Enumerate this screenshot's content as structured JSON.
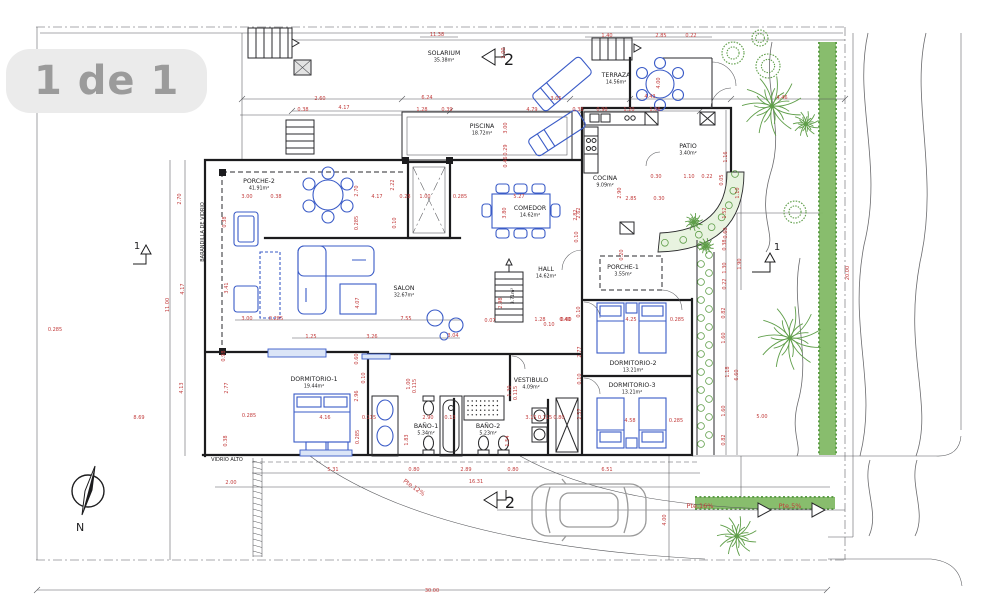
{
  "viewer": {
    "page_indicator": "1 de 1"
  },
  "colors": {
    "dimension_text": "#c23b3b",
    "ink": "#1c1c1e",
    "furniture_blue": "#3a5bc7",
    "vegetation_green": "#5f9e49",
    "hedge_fill": "#82b965",
    "paper": "#ffffff",
    "pill_bg": "#ebebeb",
    "pill_text": "#9b9b9b"
  },
  "plan": {
    "rooms": [
      {
        "name": "SOLARIUM",
        "area": "35.38m²",
        "x": 444,
        "y": 55
      },
      {
        "name": "TERRAZA",
        "area": "14.56m²",
        "x": 616,
        "y": 77
      },
      {
        "name": "PISCINA",
        "area": "18.72m²",
        "x": 482,
        "y": 128
      },
      {
        "name": "PATIO",
        "area": "3.40m²",
        "x": 688,
        "y": 148
      },
      {
        "name": "COCINA",
        "area": "9.09m²",
        "x": 605,
        "y": 180
      },
      {
        "name": "COMEDOR",
        "area": "14.62m²",
        "x": 530,
        "y": 210
      },
      {
        "name": "HALL",
        "area": "14.62m²",
        "x": 546,
        "y": 271
      },
      {
        "name": "PORCHE-1",
        "area": "3.55m²",
        "x": 623,
        "y": 269
      },
      {
        "name": "PORCHE-2",
        "area": "41.91m²",
        "x": 259,
        "y": 183
      },
      {
        "name": "SALON",
        "area": "32.67m²",
        "x": 404,
        "y": 290
      },
      {
        "name": "DORMITORIO-1",
        "area": "19.44m²",
        "x": 314,
        "y": 381
      },
      {
        "name": "DORMITORIO-2",
        "area": "13.21m²",
        "x": 633,
        "y": 365
      },
      {
        "name": "DORMITORIO-3",
        "area": "13.21m²",
        "x": 632,
        "y": 387
      },
      {
        "name": "VESTIBULO",
        "area": "4.09m²",
        "x": 531,
        "y": 382
      },
      {
        "name": "BAÑO-1",
        "area": "5.34m²",
        "x": 426,
        "y": 428
      },
      {
        "name": "BAÑO-2",
        "area": "5.23m²",
        "x": 488,
        "y": 428
      }
    ],
    "dimensions": [
      {
        "t": "11.38",
        "x": 437,
        "y": 36
      },
      {
        "t": "1.40",
        "x": 607,
        "y": 37
      },
      {
        "t": "2.85",
        "x": 661,
        "y": 37
      },
      {
        "t": "0.22",
        "x": 691,
        "y": 37
      },
      {
        "t": "2.00",
        "x": 505,
        "y": 53,
        "v": 1
      },
      {
        "t": "2.60",
        "x": 320,
        "y": 100
      },
      {
        "t": "6.24",
        "x": 427,
        "y": 99
      },
      {
        "t": "3.05",
        "x": 556,
        "y": 100
      },
      {
        "t": "4.43",
        "x": 650,
        "y": 98
      },
      {
        "t": "4.46",
        "x": 782,
        "y": 99
      },
      {
        "t": "4.00",
        "x": 660,
        "y": 83,
        "v": 1
      },
      {
        "t": "0.38",
        "x": 303,
        "y": 111
      },
      {
        "t": "4.17",
        "x": 344,
        "y": 109
      },
      {
        "t": "1.28",
        "x": 422,
        "y": 111
      },
      {
        "t": "0.39",
        "x": 447,
        "y": 111
      },
      {
        "t": "4.79",
        "x": 532,
        "y": 111
      },
      {
        "t": "0.38",
        "x": 578,
        "y": 111
      },
      {
        "t": "0.90",
        "x": 602,
        "y": 111
      },
      {
        "t": "1.20",
        "x": 629,
        "y": 111
      },
      {
        "t": "1.06",
        "x": 655,
        "y": 111
      },
      {
        "t": "3.00",
        "x": 507,
        "y": 128,
        "v": 1
      },
      {
        "t": "0.29",
        "x": 507,
        "y": 150,
        "v": 1
      },
      {
        "t": "0.46",
        "x": 507,
        "y": 162,
        "v": 1
      },
      {
        "t": "2.70",
        "x": 181,
        "y": 199,
        "v": 1
      },
      {
        "t": "4.17",
        "x": 184,
        "y": 289,
        "v": 1
      },
      {
        "t": "11.00",
        "x": 169,
        "y": 305,
        "v": 1
      },
      {
        "t": "4.13",
        "x": 183,
        "y": 388,
        "v": 1
      },
      {
        "t": "8.69",
        "x": 139,
        "y": 419
      },
      {
        "t": "0.285",
        "x": 55,
        "y": 331
      },
      {
        "t": "0.38",
        "x": 226,
        "y": 222,
        "v": 1
      },
      {
        "t": "3.41",
        "x": 228,
        "y": 288,
        "v": 1
      },
      {
        "t": "0.98",
        "x": 225,
        "y": 356,
        "v": 1
      },
      {
        "t": "2.77",
        "x": 228,
        "y": 388,
        "v": 1
      },
      {
        "t": "0.38",
        "x": 227,
        "y": 441,
        "v": 1
      },
      {
        "t": "3.00",
        "x": 247,
        "y": 198
      },
      {
        "t": "0.38",
        "x": 276,
        "y": 198
      },
      {
        "t": "2.70",
        "x": 358,
        "y": 191,
        "v": 1
      },
      {
        "t": "2.22",
        "x": 394,
        "y": 185,
        "v": 1
      },
      {
        "t": "4.17",
        "x": 377,
        "y": 198
      },
      {
        "t": "0.28",
        "x": 405,
        "y": 198
      },
      {
        "t": "1.00",
        "x": 425,
        "y": 198
      },
      {
        "t": "0.285",
        "x": 358,
        "y": 223,
        "v": 1
      },
      {
        "t": "0.10",
        "x": 396,
        "y": 223,
        "v": 1
      },
      {
        "t": "3.00",
        "x": 247,
        "y": 320
      },
      {
        "t": "0.285",
        "x": 276,
        "y": 320
      },
      {
        "t": "4.07",
        "x": 359,
        "y": 303,
        "v": 1
      },
      {
        "t": "7.55",
        "x": 406,
        "y": 320
      },
      {
        "t": "1.25",
        "x": 311,
        "y": 338
      },
      {
        "t": "3.26",
        "x": 372,
        "y": 338
      },
      {
        "t": "3.04",
        "x": 453,
        "y": 337
      },
      {
        "t": "0.285",
        "x": 460,
        "y": 198
      },
      {
        "t": "5.27",
        "x": 519,
        "y": 198
      },
      {
        "t": "3.80",
        "x": 506,
        "y": 213,
        "v": 1
      },
      {
        "t": "2.82",
        "x": 577,
        "y": 215,
        "v": 1
      },
      {
        "t": "0.10",
        "x": 578,
        "y": 237,
        "v": 1
      },
      {
        "t": "2.98",
        "x": 502,
        "y": 303,
        "v": 1
      },
      {
        "t": "0.07",
        "x": 490,
        "y": 322
      },
      {
        "t": "1.28",
        "x": 540,
        "y": 321
      },
      {
        "t": "0.10",
        "x": 549,
        "y": 326
      },
      {
        "t": "0.40",
        "x": 565,
        "y": 321
      },
      {
        "t": "1.16",
        "x": 727,
        "y": 157,
        "v": 1
      },
      {
        "t": "0.30",
        "x": 656,
        "y": 178
      },
      {
        "t": "1.10",
        "x": 689,
        "y": 178
      },
      {
        "t": "0.22",
        "x": 707,
        "y": 178
      },
      {
        "t": "0.05",
        "x": 723,
        "y": 180,
        "v": 1
      },
      {
        "t": "2.90",
        "x": 621,
        "y": 193,
        "v": 1
      },
      {
        "t": "2.85",
        "x": 631,
        "y": 200
      },
      {
        "t": "0.30",
        "x": 659,
        "y": 200
      },
      {
        "t": "2.62",
        "x": 580,
        "y": 213,
        "v": 1
      },
      {
        "t": "1.52",
        "x": 726,
        "y": 213,
        "v": 1
      },
      {
        "t": "1.10",
        "x": 739,
        "y": 193,
        "v": 1
      },
      {
        "t": "0.60",
        "x": 727,
        "y": 233,
        "v": 1
      },
      {
        "t": "0.38",
        "x": 726,
        "y": 245,
        "v": 1
      },
      {
        "t": "1.30",
        "x": 726,
        "y": 268,
        "v": 1
      },
      {
        "t": "0.22",
        "x": 726,
        "y": 284,
        "v": 1
      },
      {
        "t": "1.90",
        "x": 741,
        "y": 264,
        "v": 1
      },
      {
        "t": "0.20",
        "x": 623,
        "y": 255,
        "v": 1
      },
      {
        "t": "0.10",
        "x": 580,
        "y": 312,
        "v": 1
      },
      {
        "t": "0.60",
        "x": 566,
        "y": 321
      },
      {
        "t": "4.25",
        "x": 631,
        "y": 321
      },
      {
        "t": "0.285",
        "x": 677,
        "y": 321
      },
      {
        "t": "2.77",
        "x": 581,
        "y": 352,
        "v": 1
      },
      {
        "t": "0.10",
        "x": 581,
        "y": 379,
        "v": 1
      },
      {
        "t": "2.57",
        "x": 581,
        "y": 414,
        "v": 1
      },
      {
        "t": "4.58",
        "x": 630,
        "y": 422
      },
      {
        "t": "0.285",
        "x": 676,
        "y": 422
      },
      {
        "t": "0.82",
        "x": 725,
        "y": 313,
        "v": 1
      },
      {
        "t": "1.60",
        "x": 725,
        "y": 338,
        "v": 1
      },
      {
        "t": "1.18",
        "x": 729,
        "y": 372,
        "v": 1
      },
      {
        "t": "6.60",
        "x": 738,
        "y": 375,
        "v": 1
      },
      {
        "t": "1.60",
        "x": 725,
        "y": 411,
        "v": 1
      },
      {
        "t": "0.82",
        "x": 725,
        "y": 440,
        "v": 1
      },
      {
        "t": "5.00",
        "x": 762,
        "y": 418
      },
      {
        "t": "20.00",
        "x": 849,
        "y": 273,
        "v": 1
      },
      {
        "t": "0.60",
        "x": 358,
        "y": 359,
        "v": 1
      },
      {
        "t": "0.10",
        "x": 365,
        "y": 378,
        "v": 1
      },
      {
        "t": "2.96",
        "x": 358,
        "y": 396,
        "v": 1
      },
      {
        "t": "0.285",
        "x": 359,
        "y": 437,
        "v": 1
      },
      {
        "t": "4.16",
        "x": 325,
        "y": 419
      },
      {
        "t": "0.115",
        "x": 369,
        "y": 419
      },
      {
        "t": "1.00",
        "x": 410,
        "y": 384,
        "v": 1
      },
      {
        "t": "0.115",
        "x": 416,
        "y": 386,
        "v": 1
      },
      {
        "t": "1.83",
        "x": 408,
        "y": 440,
        "v": 1
      },
      {
        "t": "2.90",
        "x": 428,
        "y": 419
      },
      {
        "t": "0.13",
        "x": 450,
        "y": 419
      },
      {
        "t": "3.15",
        "x": 531,
        "y": 419
      },
      {
        "t": "0.115",
        "x": 545,
        "y": 419
      },
      {
        "t": "0.80",
        "x": 559,
        "y": 419
      },
      {
        "t": "1.30",
        "x": 511,
        "y": 391,
        "v": 1
      },
      {
        "t": "0.115",
        "x": 517,
        "y": 393,
        "v": 1
      },
      {
        "t": "1.54",
        "x": 509,
        "y": 441,
        "v": 1
      },
      {
        "t": "0.285",
        "x": 249,
        "y": 417
      },
      {
        "t": "5.31",
        "x": 333,
        "y": 471
      },
      {
        "t": "0.80",
        "x": 414,
        "y": 471
      },
      {
        "t": "2.89",
        "x": 466,
        "y": 471
      },
      {
        "t": "0.80",
        "x": 513,
        "y": 471
      },
      {
        "t": "6.51",
        "x": 607,
        "y": 471
      },
      {
        "t": "2.00",
        "x": 231,
        "y": 484
      },
      {
        "t": "16.31",
        "x": 476,
        "y": 483
      },
      {
        "t": "4.00",
        "x": 666,
        "y": 520,
        "v": 1
      },
      {
        "t": "30.00",
        "x": 432,
        "y": 592
      }
    ],
    "annotations": [
      {
        "t": "BARANDILLA DE VIDRIO",
        "x": 204,
        "y": 232,
        "v": 1,
        "c": "ink",
        "s": 5
      },
      {
        "t": "VIDRIO ALTO",
        "x": 227,
        "y": 461,
        "c": "ink",
        "s": 5
      },
      {
        "t": "3.71m²",
        "x": 514,
        "y": 296,
        "v": 1,
        "c": "ink",
        "s": 4.5
      },
      {
        "t": "Pte.12%",
        "x": 413,
        "y": 489,
        "r": 35,
        "c": "red",
        "s": 6
      },
      {
        "t": "Pte,16%",
        "x": 700,
        "y": 508,
        "c": "red",
        "s": 6.5
      },
      {
        "t": "Pte,5%",
        "x": 790,
        "y": 508,
        "c": "red",
        "s": 6.5
      }
    ],
    "compass": {
      "label": "N"
    },
    "section_markers": [
      {
        "label": "2",
        "x": 509,
        "y": 65,
        "s": 16
      },
      {
        "label": "2",
        "x": 510,
        "y": 508,
        "s": 16
      },
      {
        "label": "1",
        "x": 137,
        "y": 249,
        "s": 10
      },
      {
        "label": "1",
        "x": 777,
        "y": 250,
        "s": 10
      }
    ]
  }
}
